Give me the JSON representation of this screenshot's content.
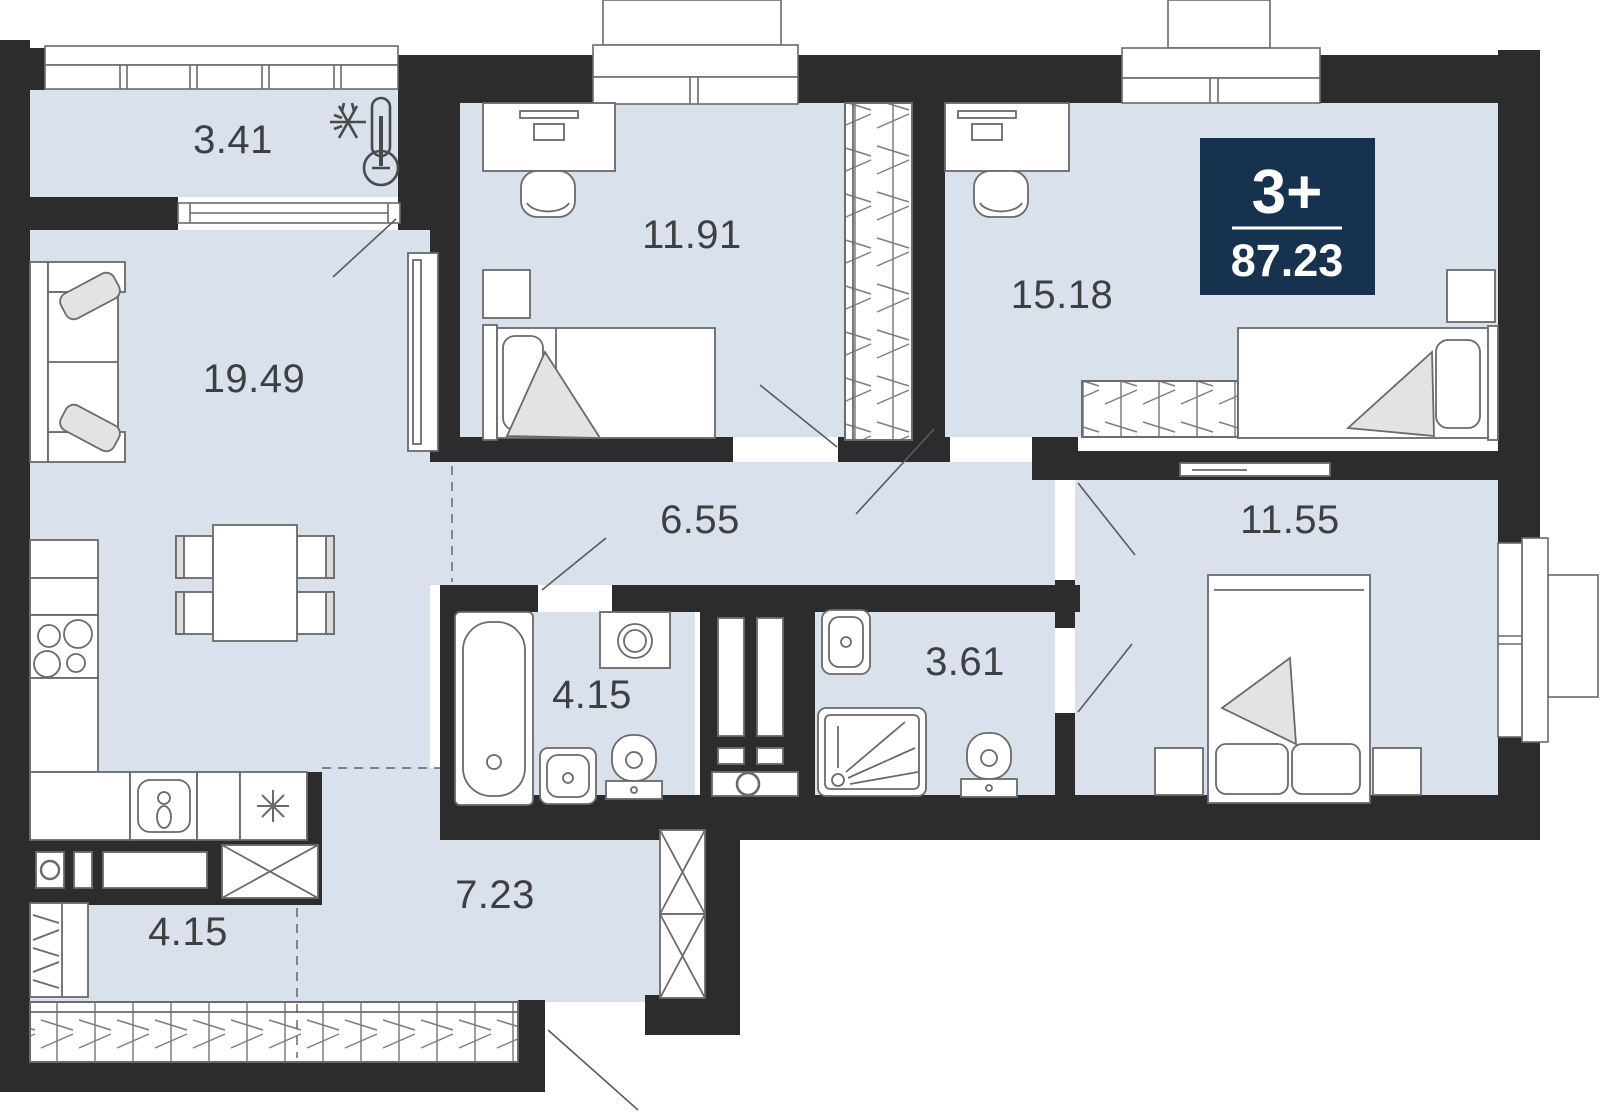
{
  "plan": {
    "badge": {
      "rooms_count": "3+",
      "total_area": "87.23"
    },
    "rooms": [
      {
        "name": "loggia",
        "area": "3.41"
      },
      {
        "name": "living-kitchen",
        "area": "19.49"
      },
      {
        "name": "bedroom-1",
        "area": "11.91"
      },
      {
        "name": "bedroom-2",
        "area": "15.18"
      },
      {
        "name": "corridor",
        "area": "6.55"
      },
      {
        "name": "bedroom-3",
        "area": "11.55"
      },
      {
        "name": "bathroom",
        "area": "4.15"
      },
      {
        "name": "shower-room",
        "area": "3.61"
      },
      {
        "name": "hallway",
        "area": "7.23"
      },
      {
        "name": "closet",
        "area": "4.15"
      }
    ],
    "icons": [
      {
        "name": "cold-loggia-thermometer-icon"
      },
      {
        "name": "snowflake-icon"
      },
      {
        "name": "dishwasher-icon"
      }
    ],
    "colors": {
      "wall": "#2c2c2c",
      "floor": "#d8e1ec",
      "badge_bg": "#16324f",
      "furniture_stroke": "#6a6a6a",
      "label_text": "#3f3f42"
    }
  }
}
